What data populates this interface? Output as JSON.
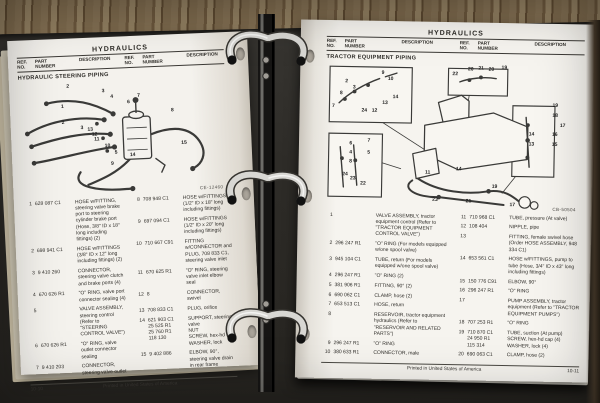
{
  "left_page": {
    "title": "HYDRAULICS",
    "section_title": "HYDRAULIC STEERING PIPING",
    "figure_code": "CE-12460",
    "columns": {
      "ref": "REF.\nNO.",
      "part": "PART\nNUMBER",
      "desc": "DESCRIPTION"
    },
    "footer": {
      "page_number": "10-10",
      "printed": "Printed in United States of America"
    },
    "parts_col1": [
      {
        "ref": "1",
        "part": "628 087 C1",
        "desc": "HOSE w/FITTING, steering valve brake port to steering cylinder brake port (Hose, 3/8\" ID x 18\" long including fittings) (2)"
      },
      {
        "ref": "2",
        "part": "698 941 C1",
        "desc": "HOSE w/FITTINGS (3/8\" ID x 12\" long including fittings) (2)"
      },
      {
        "ref": "3",
        "part": "9 410 260",
        "desc": "CONNECTOR, steering valve clutch and brake ports (4)"
      },
      {
        "ref": "4",
        "part": "670 626 R1",
        "desc": "\"O\" RING, valve port connector sealing (4)"
      },
      {
        "ref": "5",
        "part": "",
        "desc": "VALVE ASSEMBLY, steering control (Refer to \"STEERING CONTROL VALVE\")"
      },
      {
        "ref": "6",
        "part": "670 626 R1",
        "desc": "\"O\" RING, valve outlet connector sealing"
      },
      {
        "ref": "7",
        "part": "9 410 203",
        "desc": "CONNECTOR, steering valve outlet"
      }
    ],
    "parts_col2": [
      {
        "ref": "8",
        "part": "708 948 C1",
        "desc": "HOSE w/FITTINGS (1/2\" ID x 18\" long including fittings)"
      },
      {
        "ref": "9",
        "part": "697 094 C1",
        "desc": "HOSE w/FITTINGS (1/2\" ID x 20\" long including fittings)"
      },
      {
        "ref": "10",
        "part": "710 667 C91",
        "desc": "FITTING w/CONNECTOR and PLUG, 708 833 C1, steering valve inlet"
      },
      {
        "ref": "11",
        "part": "670 625 R1",
        "desc": "\"O\" RING, steering valve inlet elbow seal"
      },
      {
        "ref": "12",
        "part": "8",
        "desc": "CONNECTOR, swivel"
      },
      {
        "ref": "13",
        "part": "708 833 C1",
        "desc": "PLUG, orifice"
      },
      {
        "ref": "14",
        "part": "621 903 C1\n25 525 R1\n25 760 R1\n118 130",
        "desc": "SUPPORT, steering valve\nNUT\nSCREW, hex-hd cap\nWASHER, lock"
      },
      {
        "ref": "15",
        "part": "9 402 886",
        "desc": "ELBOW, 90°, steering valve drain in rear frame"
      }
    ],
    "callouts": [
      {
        "n": "2",
        "x": 24,
        "y": 5
      },
      {
        "n": "3",
        "x": 41,
        "y": 10
      },
      {
        "n": "4",
        "x": 45,
        "y": 15
      },
      {
        "n": "1",
        "x": 21,
        "y": 22
      },
      {
        "n": "2",
        "x": 21,
        "y": 36
      },
      {
        "n": "3",
        "x": 30,
        "y": 41
      },
      {
        "n": "6",
        "x": 53,
        "y": 20
      },
      {
        "n": "7",
        "x": 58,
        "y": 15
      },
      {
        "n": "8",
        "x": 74,
        "y": 29
      },
      {
        "n": "15",
        "x": 79,
        "y": 57
      },
      {
        "n": "13",
        "x": 34,
        "y": 43
      },
      {
        "n": "12",
        "x": 36,
        "y": 47
      },
      {
        "n": "11",
        "x": 37,
        "y": 51
      },
      {
        "n": "10",
        "x": 42,
        "y": 57
      },
      {
        "n": "5",
        "x": 46,
        "y": 63
      },
      {
        "n": "14",
        "x": 54,
        "y": 66
      },
      {
        "n": "9",
        "x": 44,
        "y": 73
      }
    ]
  },
  "right_page": {
    "title": "HYDRAULICS",
    "section_title": "TRACTOR EQUIPMENT PIPING",
    "figure_code": "CB-50504",
    "columns": {
      "ref": "REF.\nNO.",
      "part": "PART\nNUMBER",
      "desc": "DESCRIPTION"
    },
    "footer": {
      "page_number": "10-11",
      "printed": "Printed in United States of America"
    },
    "parts_col1": [
      {
        "ref": "1",
        "part": "",
        "desc": "VALVE ASSEMBLY, tractor equipment control (Refer to \"TRACTOR EQUIPMENT CONTROL VALVE\")"
      },
      {
        "ref": "2",
        "part": "296 247 R1",
        "desc": "\"O\" RING (For models equipped w/one spool valve)"
      },
      {
        "ref": "3",
        "part": "945 104 C1",
        "desc": "TUBE, return (For models equipped w/one spool valve)"
      },
      {
        "ref": "4",
        "part": "296 247 R1",
        "desc": "\"O\" RING (2)"
      },
      {
        "ref": "5",
        "part": "381 906 R1",
        "desc": "FITTING, 90° (2)"
      },
      {
        "ref": "6",
        "part": "690 062 C1",
        "desc": "CLAMP, hose (2)"
      },
      {
        "ref": "7",
        "part": "653 513 C1",
        "desc": "HOSE, return"
      },
      {
        "ref": "8",
        "part": "",
        "desc": "RESERVOIR, tractor equipment hydraulics (Refer to \"RESERVOIR AND RELATED PARTS\")"
      },
      {
        "ref": "9",
        "part": "296 247 R1",
        "desc": "\"O\" RING"
      },
      {
        "ref": "10",
        "part": "380 633 R1",
        "desc": "CONNECTOR, male"
      }
    ],
    "parts_col2": [
      {
        "ref": "11",
        "part": "710 968 C1",
        "desc": "TUBE, pressure (At valve)"
      },
      {
        "ref": "12",
        "part": "108 404",
        "desc": "NIPPLE, pipe"
      },
      {
        "ref": "13",
        "part": "",
        "desc": "FITTING, female swivel hose (Order HOSE ASSEMBLY, 948 334 C1)"
      },
      {
        "ref": "14",
        "part": "653 561 C1",
        "desc": "HOSE w/FITTINGS, pump to tube (Hose, 3/4\" ID x 43\" long including fittings)"
      },
      {
        "ref": "15",
        "part": "150 776 C91",
        "desc": "ELBOW, 90°"
      },
      {
        "ref": "16",
        "part": "296 247 R1",
        "desc": "\"O\" RING"
      },
      {
        "ref": "17",
        "part": "",
        "desc": "PUMP ASSEMBLY, tractor equipment (Refer to \"TRACTOR EQUIPMENT PUMPS\")"
      },
      {
        "ref": "18",
        "part": "707 253 R1",
        "desc": "\"O\" RING"
      },
      {
        "ref": "19",
        "part": "710 870 C1\n24 950 R1\n115 314",
        "desc": "TUBE, suction (At pump)\nSCREW, hex-hd cap (4)\nWASHER, lock (4)"
      },
      {
        "ref": "20",
        "part": "690 063 C1",
        "desc": "CLAMP, hose (2)"
      }
    ],
    "callouts": [
      {
        "n": "9",
        "x": 22,
        "y": 7
      },
      {
        "n": "10",
        "x": 25,
        "y": 11
      },
      {
        "n": "2",
        "x": 8,
        "y": 13
      },
      {
        "n": "3",
        "x": 11,
        "y": 17
      },
      {
        "n": "8",
        "x": 6,
        "y": 21
      },
      {
        "n": "7",
        "x": 3,
        "y": 30
      },
      {
        "n": "14",
        "x": 27,
        "y": 23
      },
      {
        "n": "13",
        "x": 23,
        "y": 27
      },
      {
        "n": "24",
        "x": 15,
        "y": 33
      },
      {
        "n": "12",
        "x": 19,
        "y": 33
      },
      {
        "n": "22",
        "x": 50,
        "y": 7
      },
      {
        "n": "20",
        "x": 56,
        "y": 4
      },
      {
        "n": "21",
        "x": 60,
        "y": 3
      },
      {
        "n": "20",
        "x": 64,
        "y": 4
      },
      {
        "n": "19",
        "x": 69,
        "y": 2
      },
      {
        "n": "19",
        "x": 89,
        "y": 27
      },
      {
        "n": "18",
        "x": 89,
        "y": 34
      },
      {
        "n": "17",
        "x": 92,
        "y": 41
      },
      {
        "n": "16",
        "x": 89,
        "y": 47
      },
      {
        "n": "14",
        "x": 80,
        "y": 47
      },
      {
        "n": "15",
        "x": 89,
        "y": 54
      },
      {
        "n": "13",
        "x": 80,
        "y": 54
      },
      {
        "n": "6",
        "x": 10,
        "y": 55
      },
      {
        "n": "7",
        "x": 17,
        "y": 53
      },
      {
        "n": "4",
        "x": 10,
        "y": 61
      },
      {
        "n": "5",
        "x": 17,
        "y": 61
      },
      {
        "n": "8",
        "x": 10,
        "y": 67
      },
      {
        "n": "24",
        "x": 8,
        "y": 76
      },
      {
        "n": "23",
        "x": 11,
        "y": 79
      },
      {
        "n": "22",
        "x": 15,
        "y": 82
      },
      {
        "n": "11",
        "x": 40,
        "y": 74
      },
      {
        "n": "14",
        "x": 52,
        "y": 71
      },
      {
        "n": "23",
        "x": 43,
        "y": 92
      },
      {
        "n": "21",
        "x": 56,
        "y": 93
      },
      {
        "n": "19",
        "x": 66,
        "y": 83
      },
      {
        "n": "17",
        "x": 73,
        "y": 95
      }
    ]
  }
}
